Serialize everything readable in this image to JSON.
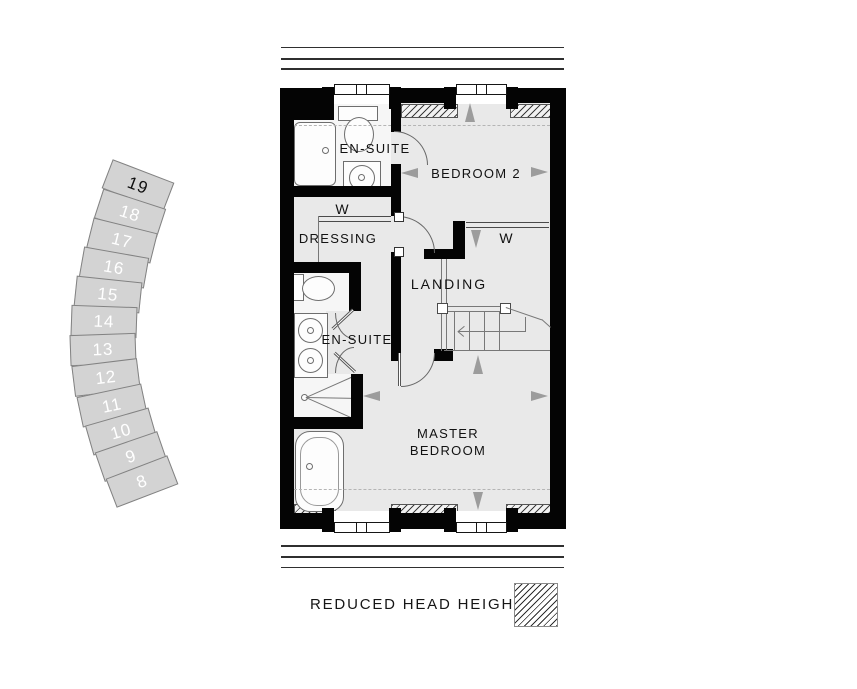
{
  "plan": {
    "rooms": {
      "ensuite_top": "EN-SUITE",
      "bedroom2": "BEDROOM 2",
      "wardrobe_dressing": "W",
      "dressing": "DRESSING",
      "wardrobe_bedroom2": "W",
      "landing": "LANDING",
      "ensuite_mid": "EN-SUITE",
      "master_line1": "MASTER",
      "master_line2": "BEDROOM"
    }
  },
  "stairs_detail": {
    "steps": [
      "19",
      "18",
      "17",
      "16",
      "15",
      "14",
      "13",
      "12",
      "11",
      "10",
      "9",
      "8"
    ],
    "highlighted_step": "19"
  },
  "legend": {
    "label": "REDUCED HEAD HEIGHTS"
  },
  "colors": {
    "wall": "#040404",
    "floor": "#e9e9e9",
    "step_fill": "#d3d3d3",
    "arrow": "#9c9c9c"
  }
}
